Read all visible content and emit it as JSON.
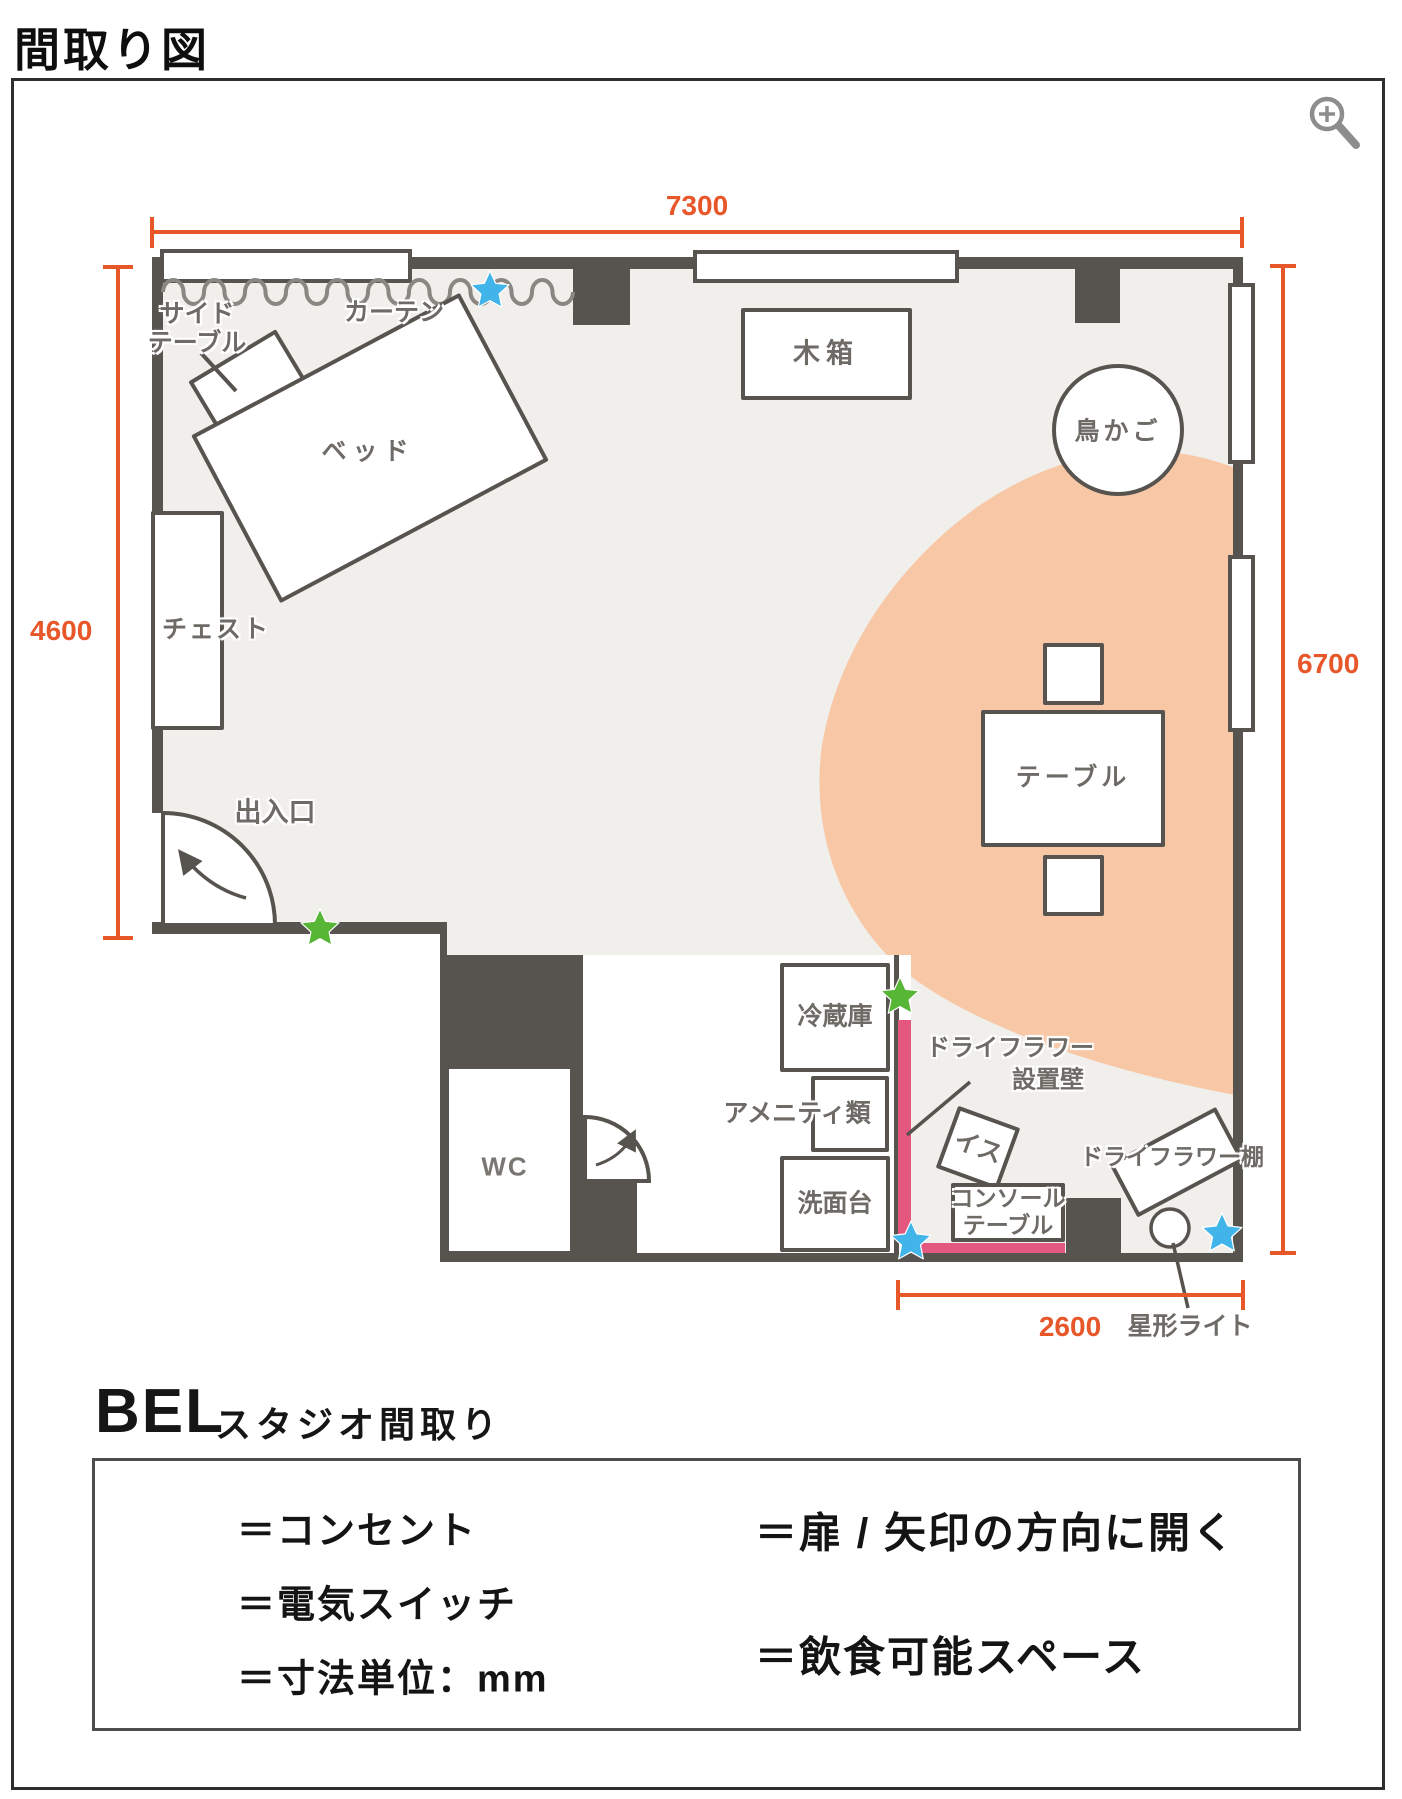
{
  "page": {
    "title": "間取り図"
  },
  "viewer": {
    "zoom_icon": "magnifier"
  },
  "plan": {
    "dimensions": {
      "top": "7300",
      "left": "4600",
      "right": "6700",
      "bottom": "2600"
    },
    "labels": {
      "side_table_line1": "サイド",
      "side_table_line2": "テーブル",
      "curtain": "カーテン",
      "bed": "ベッド",
      "chest": "チェスト",
      "entrance": "出入口",
      "wooden_box": "木箱",
      "birdcage": "鳥かご",
      "table": "テーブル",
      "wc": "WC",
      "refrigerator": "冷蔵庫",
      "amenities": "アメニティ類",
      "washbasin": "洗面台",
      "chair": "イス",
      "console_line1": "コンソール",
      "console_line2": "テーブル",
      "flower_wall_line1": "ドライフラワー",
      "flower_wall_line2": "設置壁",
      "flower_shelf": "ドライフラワー棚",
      "star_light": "星形ライト"
    }
  },
  "legend": {
    "logo": "BEL",
    "subtitle": "スタジオ間取り",
    "items": [
      {
        "symbol": "outlet-star",
        "label": "＝コンセント"
      },
      {
        "symbol": "switch-star",
        "label": "＝電気スイッチ"
      },
      {
        "symbol": "dimension-gauge",
        "label": "＝寸法単位：mm"
      },
      {
        "symbol": "door-swing",
        "label": "＝扉 / 矢印の方向に開く"
      },
      {
        "symbol": "dining-ellipse",
        "label": "＝飲食可能スペース"
      }
    ]
  },
  "colors": {
    "wall": "#57534f",
    "floor": "#f1efeb",
    "dining_space": "#f8c8a6",
    "dimension_accent": "#e8572a",
    "outlet_star_blue": "#41b4ea",
    "switch_star_green": "#58b637",
    "flower_wall_pink": "#e4577f",
    "label_gray": "#6e6a66"
  }
}
